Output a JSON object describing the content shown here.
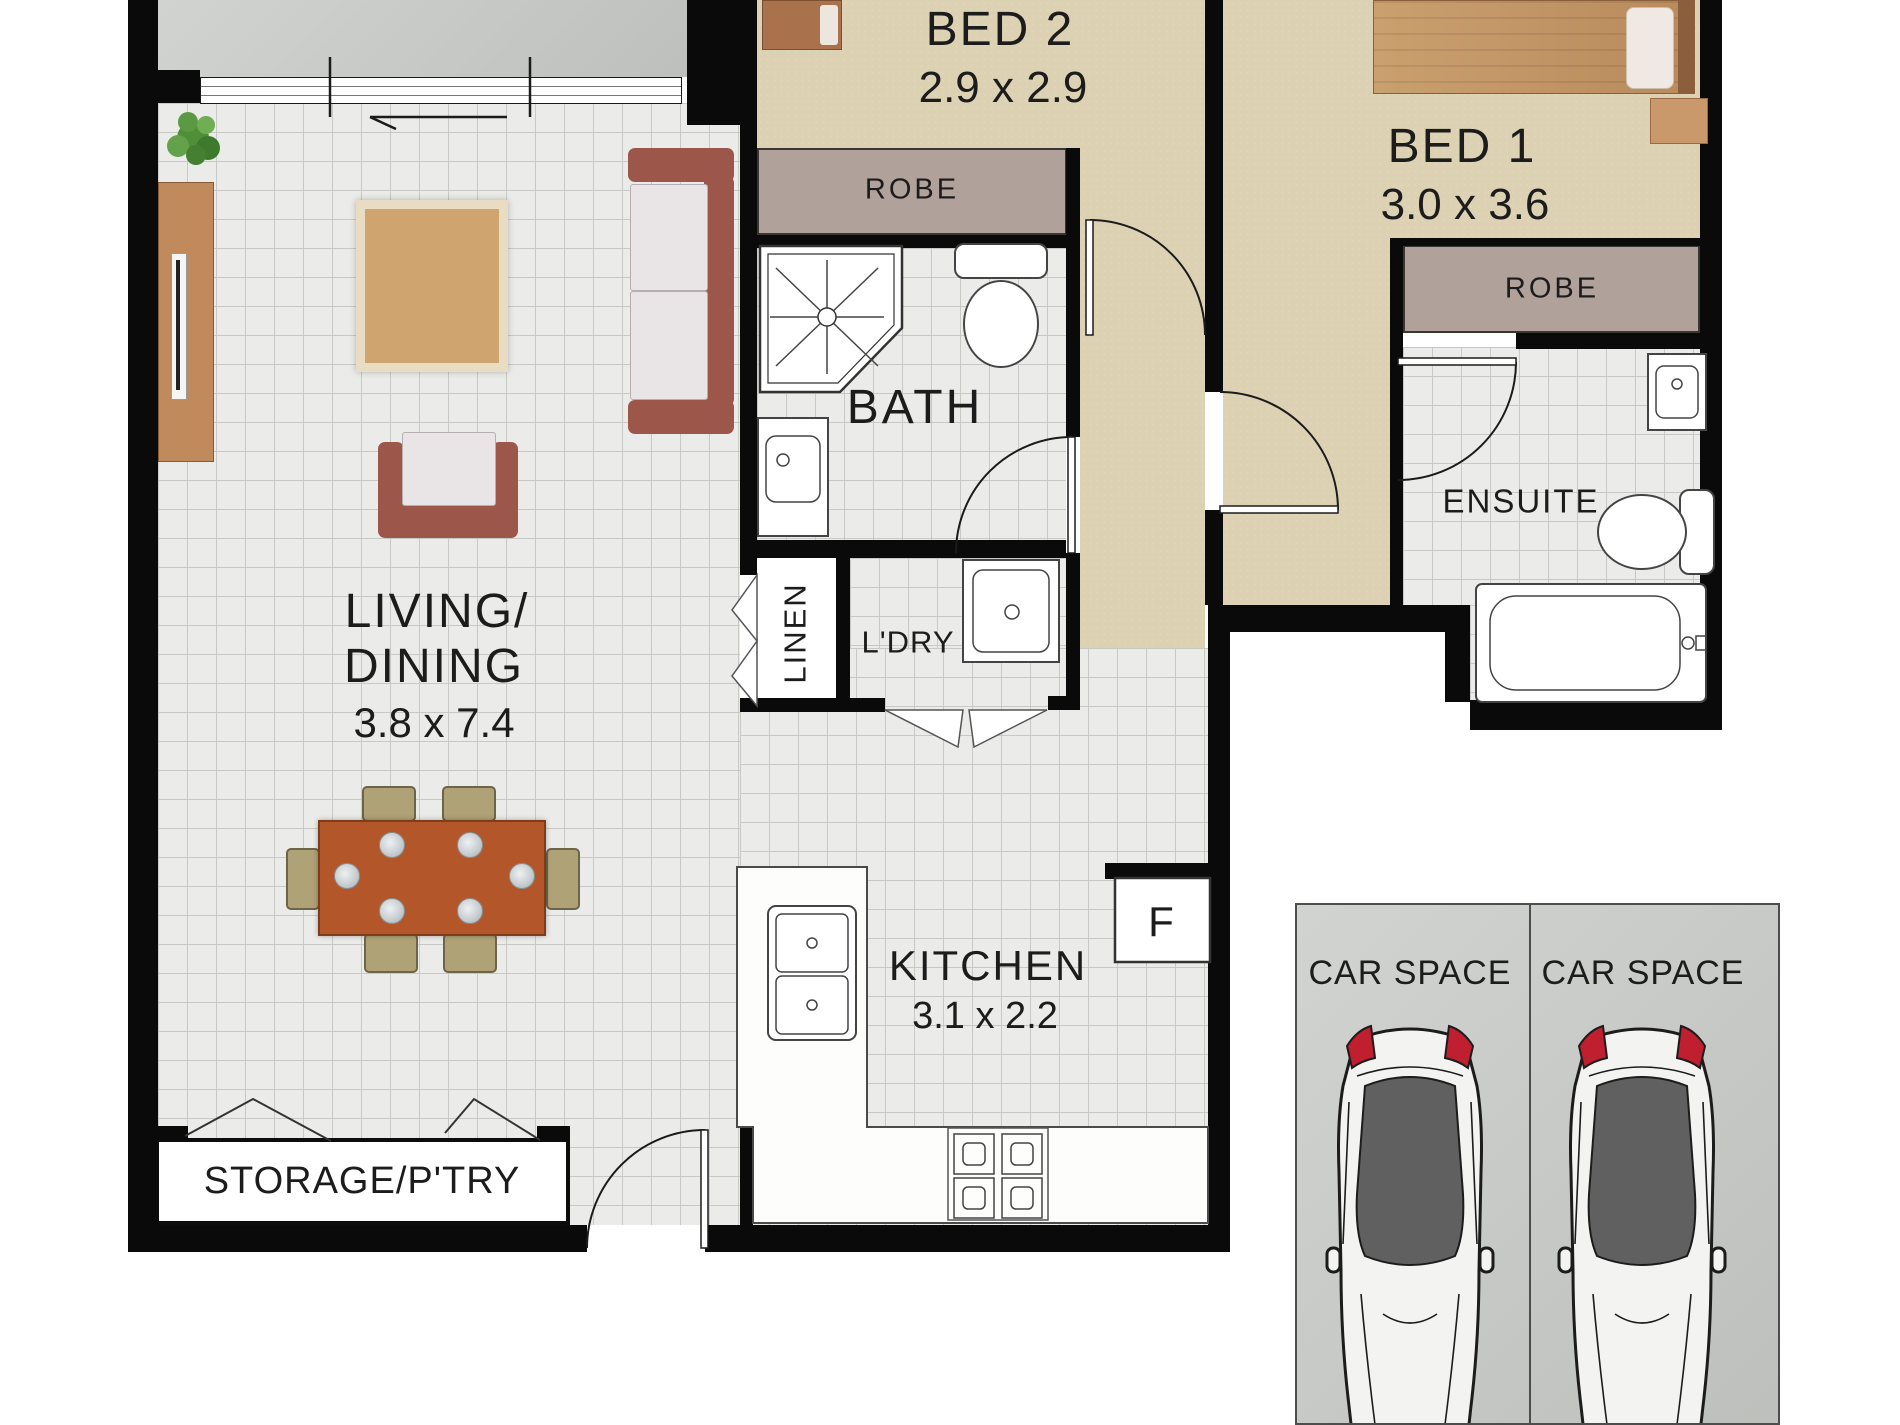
{
  "title": "Apartment floor plan with two car spaces",
  "labels": {
    "bed2": "BED 2",
    "bed2_dims": "2.9 x 2.9",
    "bed1": "BED 1",
    "bed1_dims": "3.0 x 3.6",
    "robe_bed2": "ROBE",
    "robe_bed1": "ROBE",
    "bath": "BATH",
    "ensuite": "ENSUITE",
    "linen": "LINEN",
    "laundry": "L'DRY",
    "living_line1": "LIVING/",
    "living_line2": "DINING",
    "living_dims": "3.8 x 7.4",
    "kitchen": "KITCHEN",
    "kitchen_dims": "3.1 x 2.2",
    "fridge": "F",
    "storage": "STORAGE/P'TRY",
    "car_space_left": "CAR SPACE",
    "car_space_right": "CAR SPACE"
  },
  "colors": {
    "wall": "#0a0a0a",
    "carpet": "#dcd1b2",
    "robe": "#b1a19b",
    "tile-bg": "#ebebe9",
    "tile-line": "#c8c8c5",
    "concrete": "#c7cac6",
    "text": "#1c1c1c",
    "sofa": "#9c574a",
    "cushion": "#e9e5e7",
    "table": "#b3572a",
    "chair": "#b0a277",
    "wood": "#c08a5c",
    "tail-light": "#c01f2f",
    "glass": "#606060",
    "fixture-line": "#444444"
  }
}
